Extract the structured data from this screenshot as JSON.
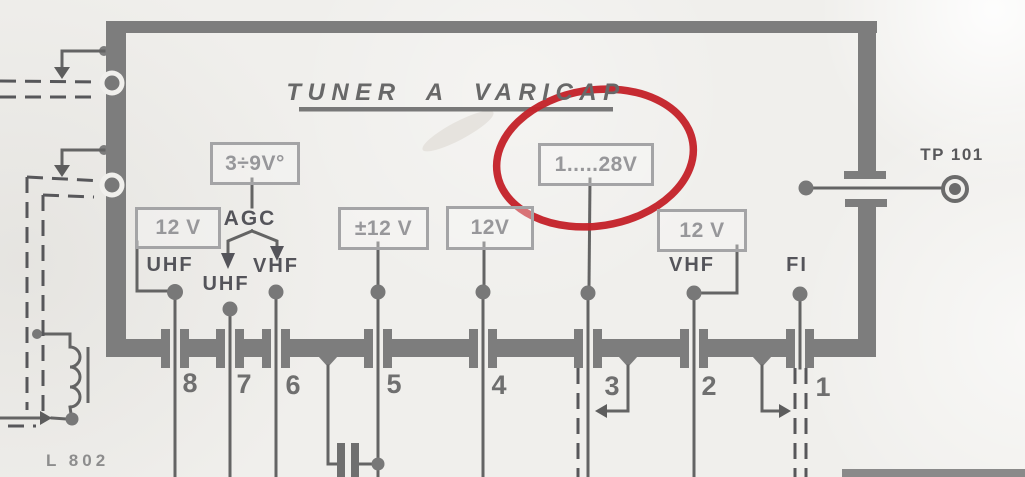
{
  "title": {
    "text": "TUNER A VARICAP"
  },
  "voltage_boxes": [
    {
      "id": "agc-range-box",
      "label": "3÷9V°"
    },
    {
      "id": "uhf-supply-box",
      "label": "12 V"
    },
    {
      "id": "plusminus-12v-box",
      "label": "±12 V"
    },
    {
      "id": "pin4-supply-box",
      "label": "12V"
    },
    {
      "id": "tuning-voltage-box",
      "label": "1.....28V",
      "highlighted": true
    },
    {
      "id": "vhf-supply-box",
      "label": "12 V"
    }
  ],
  "signal_labels": {
    "agc": "AGC",
    "uhf_top": "UHF",
    "uhf_mid": "UHF",
    "vhf_left": "VHF",
    "vhf_right": "VHF",
    "fi": "FI"
  },
  "test_point": {
    "label": "TP 101"
  },
  "inductor_label": "L 802",
  "pins": [
    {
      "number": "8"
    },
    {
      "number": "7"
    },
    {
      "number": "6"
    },
    {
      "number": "5"
    },
    {
      "number": "4"
    },
    {
      "number": "3"
    },
    {
      "number": "2"
    },
    {
      "number": "1"
    }
  ],
  "annotation": {
    "type": "hand-drawn-ellipse",
    "color": "#c4222a",
    "highlights": "1.....28V"
  },
  "colors": {
    "block_outline": "#7d7d7d",
    "wire": "#646464",
    "box_outline": "#a4a4a6",
    "box_text": "#97979a",
    "background": "#f0efec"
  }
}
